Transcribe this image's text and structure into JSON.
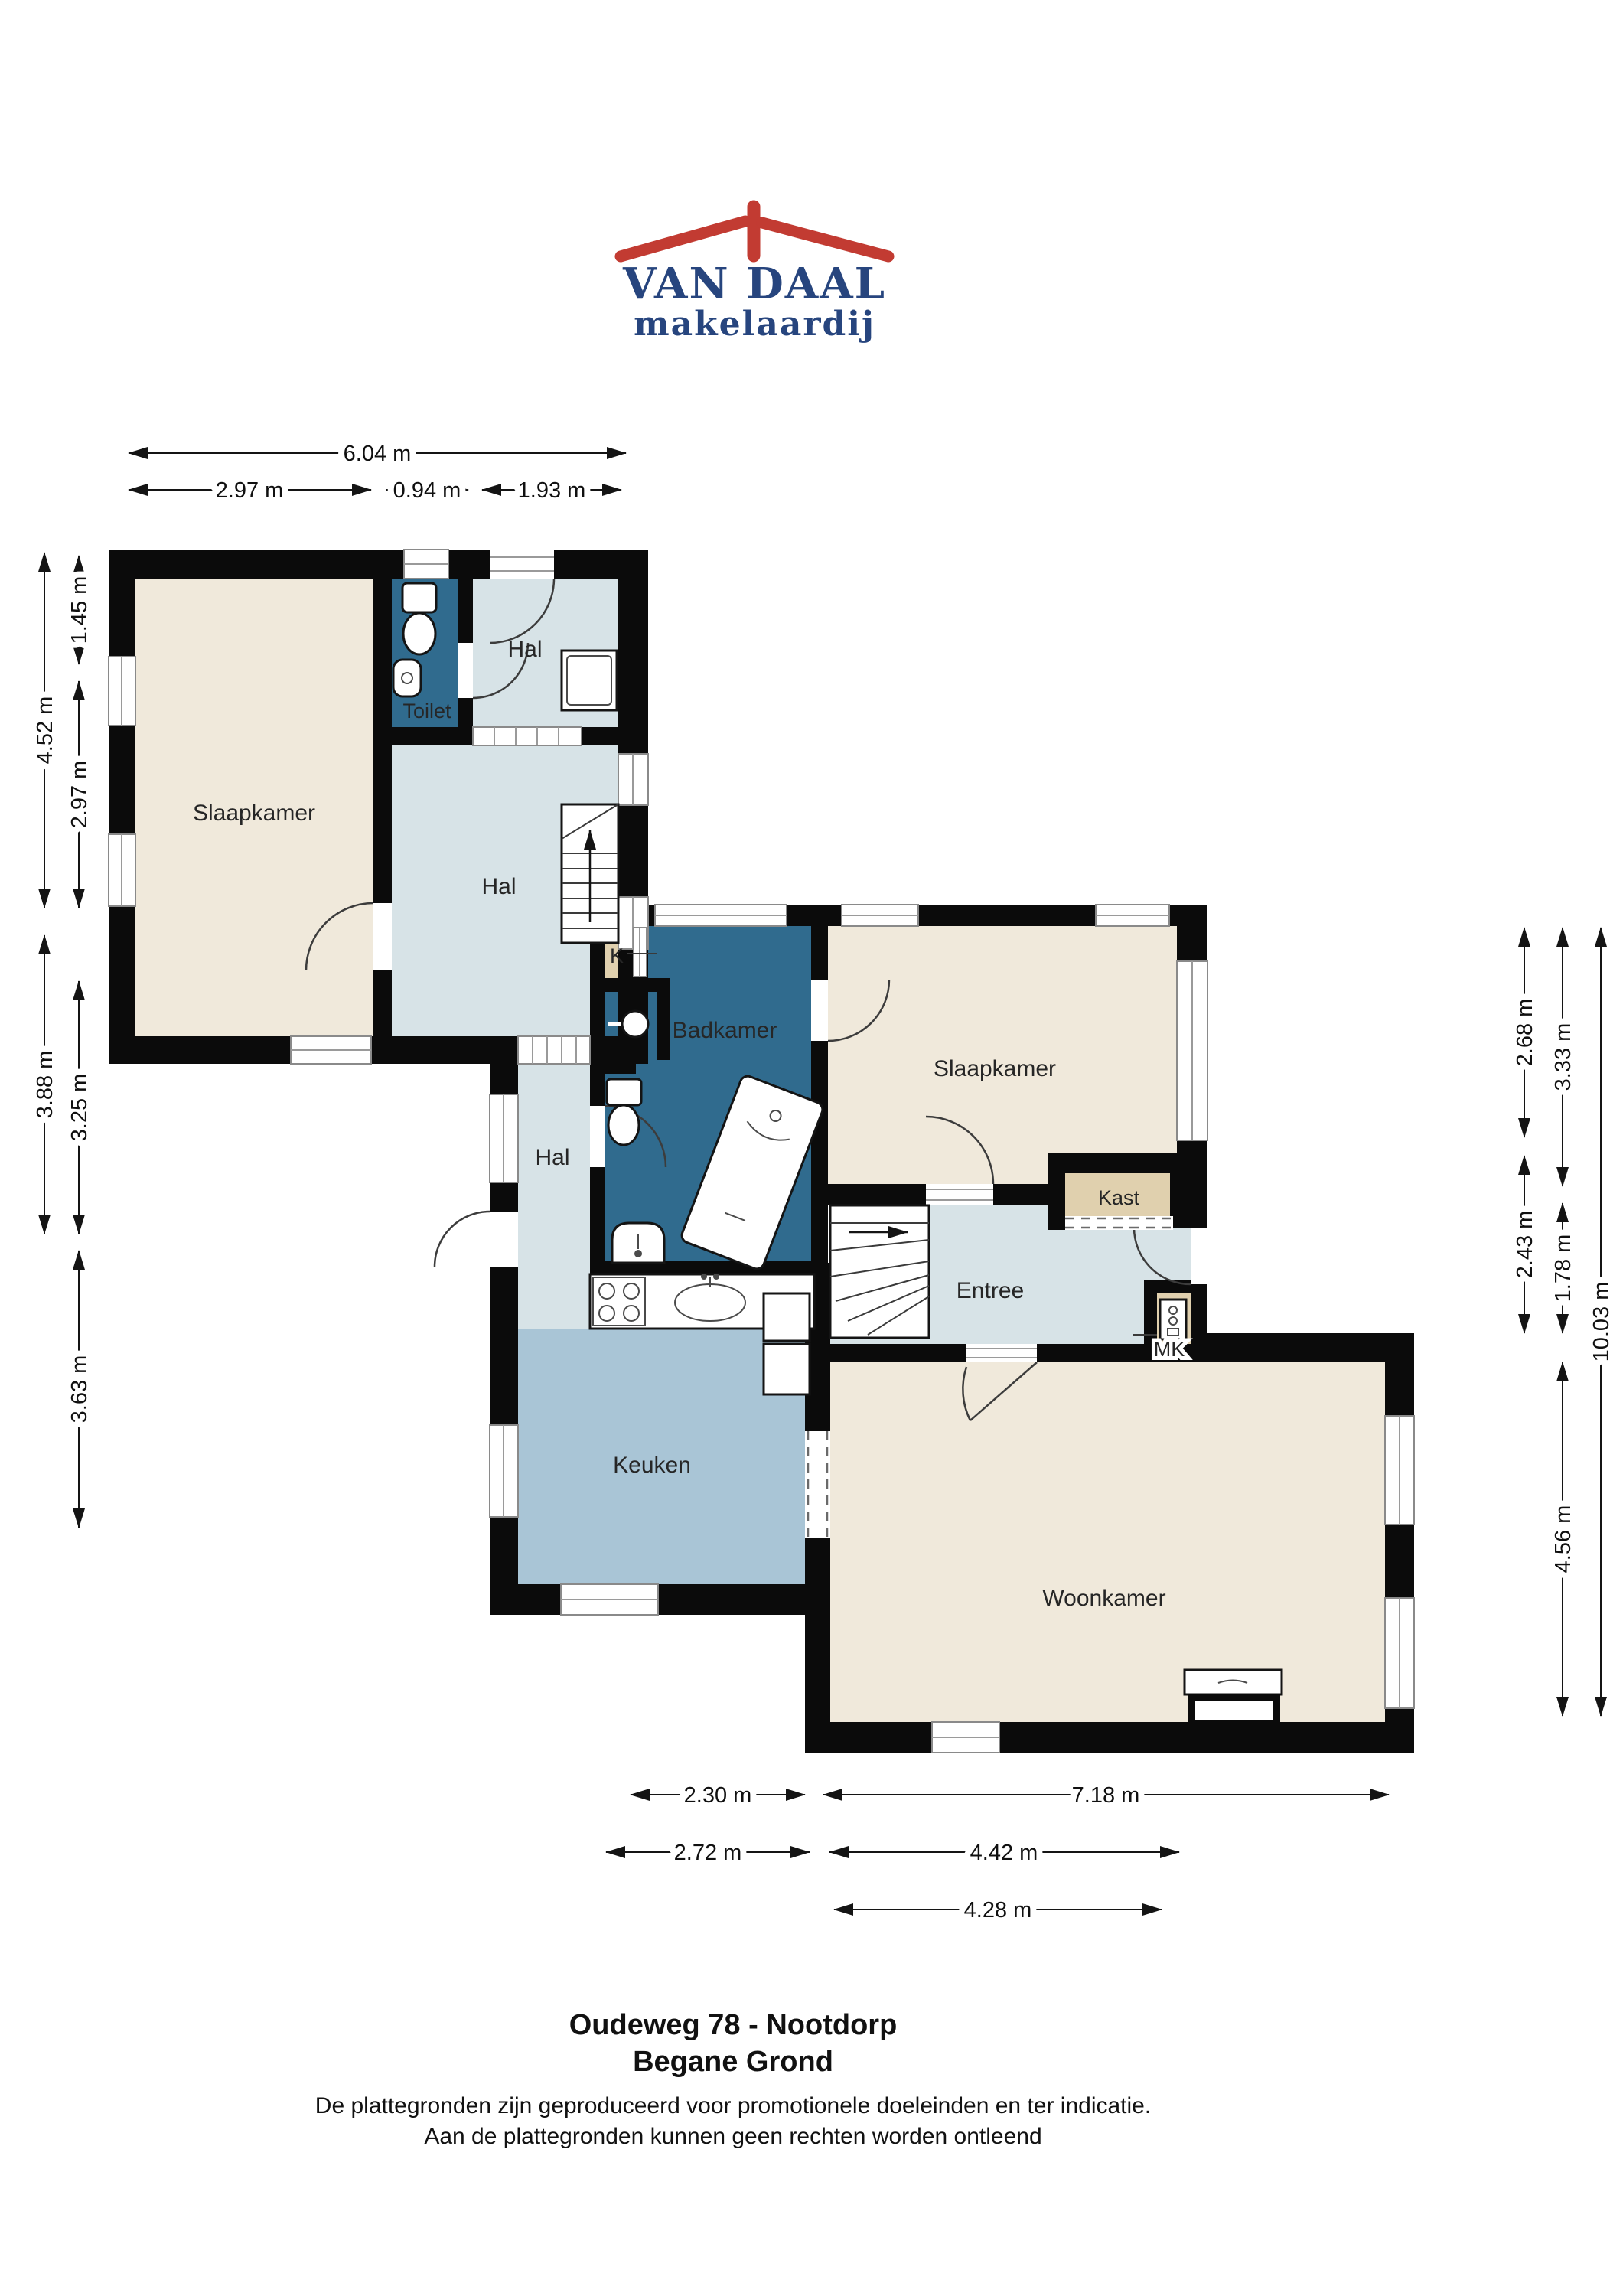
{
  "logo": {
    "title": "VAN DAAL",
    "subtitle": "makelaardij",
    "roof_color": "#c23b32",
    "text_color": "#27457e"
  },
  "colors": {
    "wall": "#0b0b0b",
    "room_beige": "#f0e9db",
    "room_light_blue": "#d7e3e7",
    "room_medium_blue": "#a9c5d6",
    "room_dark_blue": "#306b8e",
    "room_tan": "#e0d0ae",
    "dimension_text": "#101010"
  },
  "rooms": {
    "slaapkamer_links": "Slaapkamer",
    "toilet": "Toilet",
    "hal_boven": "Hal",
    "hal_midden": "Hal",
    "hal_gang": "Hal",
    "badkamer": "Badkamer",
    "k_closet": "K",
    "slaapkamer_rechts": "Slaapkamer",
    "kast": "Kast",
    "entree": "Entree",
    "meterkast": "MK",
    "keuken": "Keuken",
    "woonkamer": "Woonkamer"
  },
  "dims": {
    "w_total": "6.04 m",
    "w_a": "2.97 m",
    "w_b": "0.94 m",
    "w_c": "1.93 m",
    "h_left_total": "4.52 m",
    "h_left_a": "1.45 m",
    "h_left_b": "2.97 m",
    "h_left2_total": "3.88 m",
    "h_left2_a": "3.25 m",
    "h_left2_b": "3.63 m",
    "h_right_a": "2.68 m",
    "h_right_b": "2.43 m",
    "h_right_c": "3.33 m",
    "h_right_d": "1.78 m",
    "h_right_e": "4.56 m",
    "h_right_total": "10.03 m",
    "w_bot_a": "2.30 m",
    "w_bot_b": "7.18 m",
    "w_bot_c": "2.72 m",
    "w_bot_d": "4.42 m",
    "w_bot_e": "4.28 m"
  },
  "footer": {
    "title_line1": "Oudeweg 78 - Nootdorp",
    "title_line2": "Begane Grond",
    "disclaimer_line1": "De plattegronden zijn geproduceerd voor promotionele doeleinden en ter indicatie.",
    "disclaimer_line2": "Aan de plattegronden kunnen geen rechten worden ontleend"
  }
}
